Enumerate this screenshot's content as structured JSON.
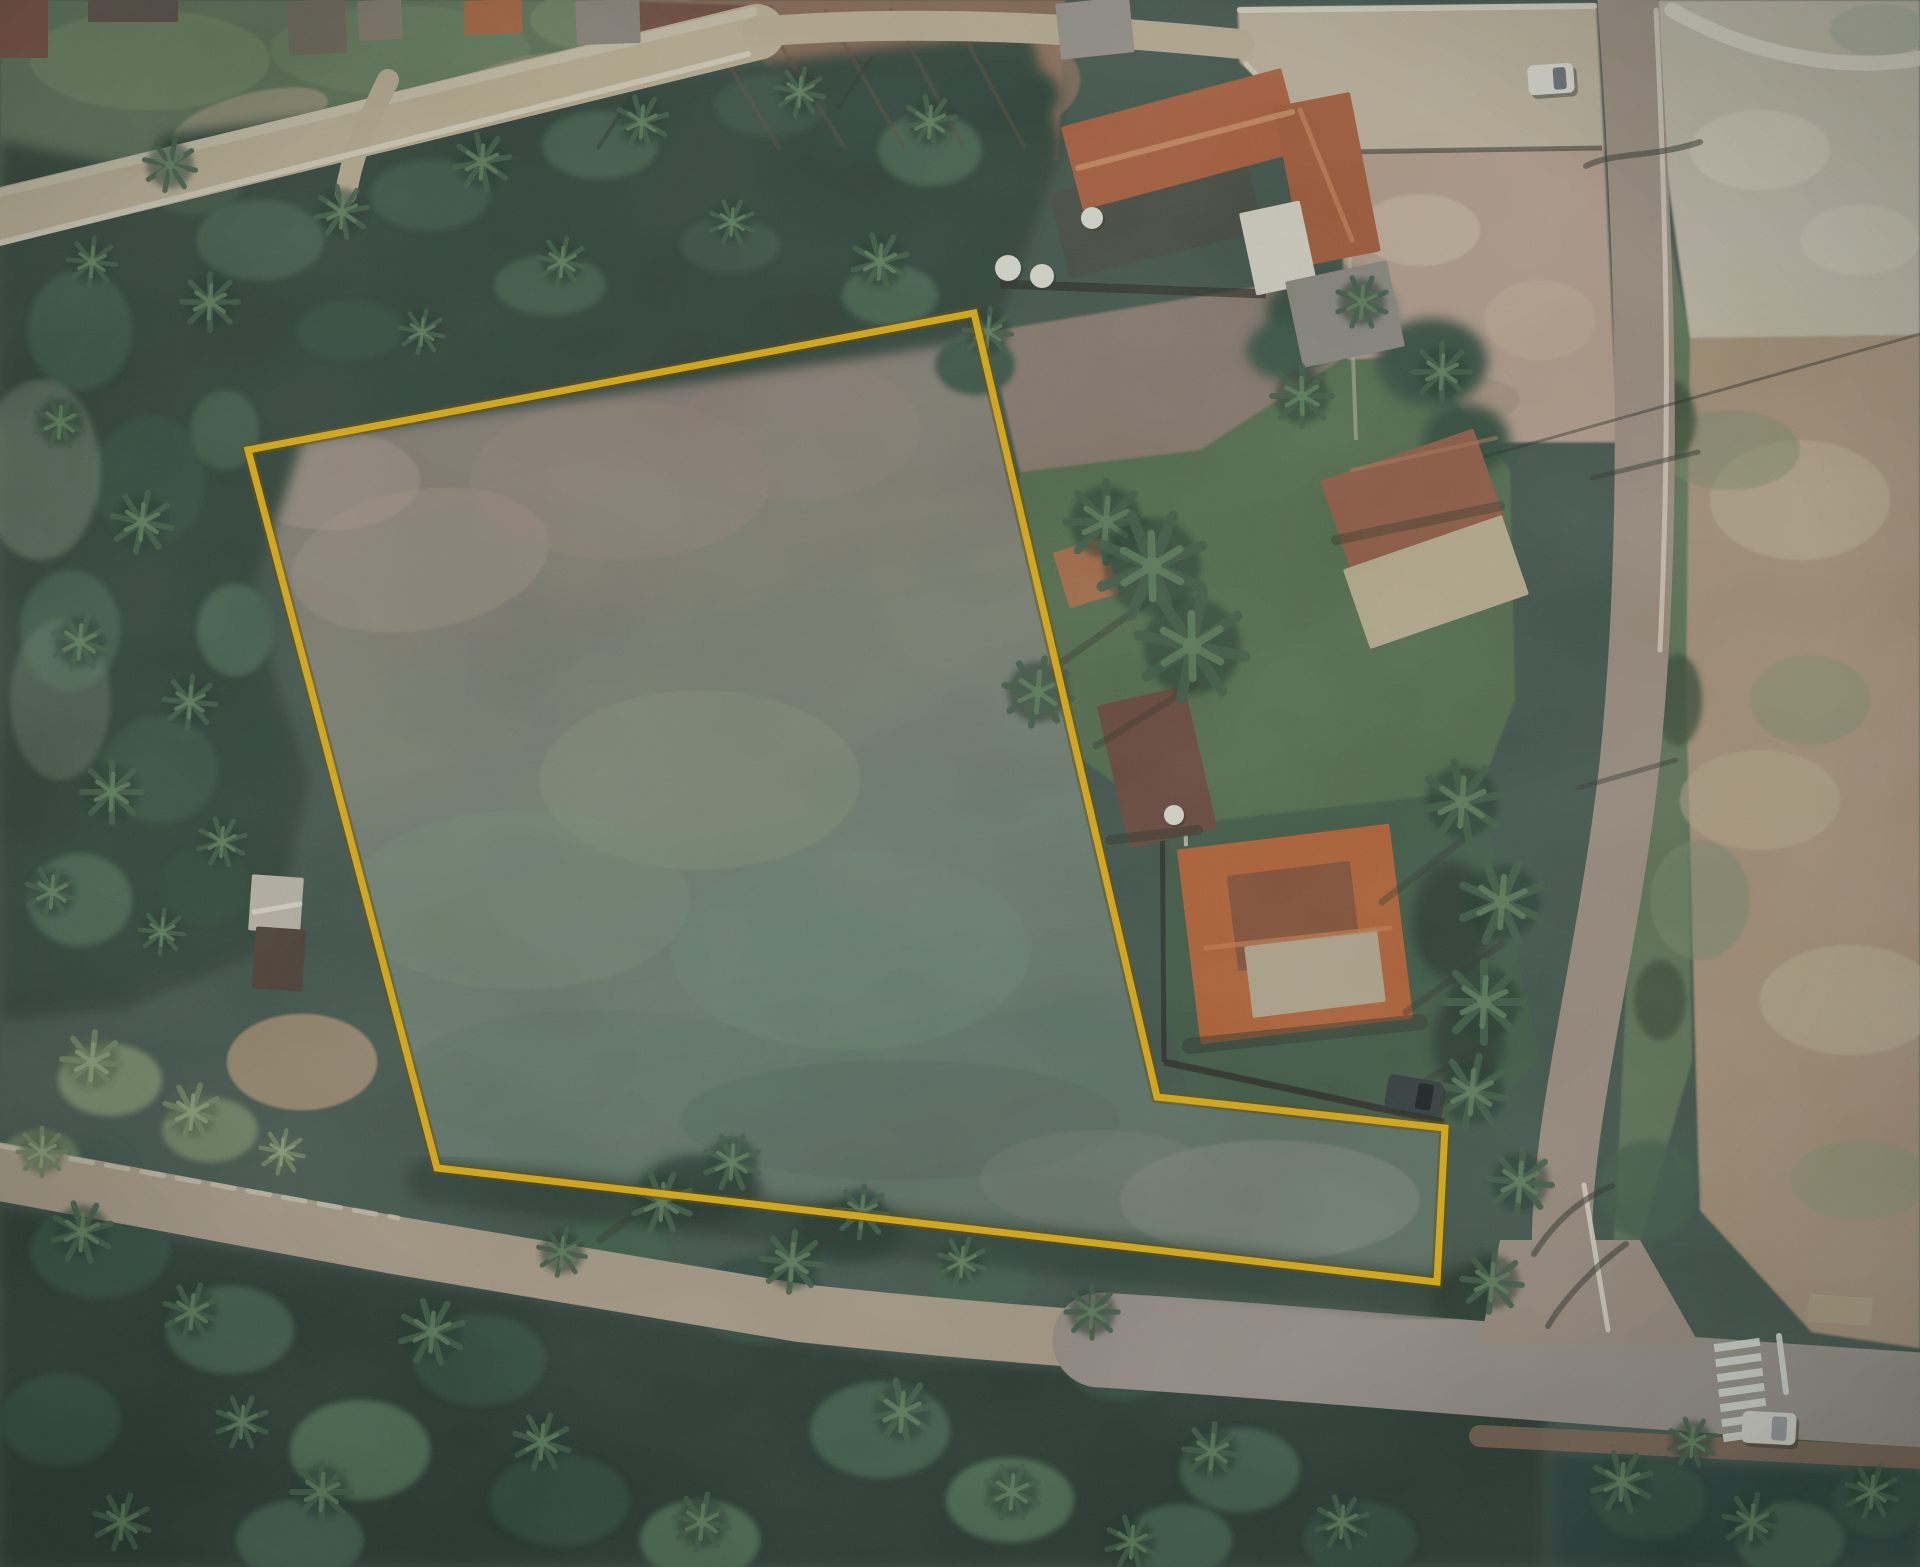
{
  "meta": {
    "description": "Satellite aerial photograph of a rural land parcel outlined with a yellow property boundary overlay",
    "canvas": {
      "w": 1920,
      "h": 1567
    }
  },
  "overlay": {
    "property_boundary": {
      "color": "#F6B80C",
      "outline_color": "#5F4A00",
      "stroke_width": 7,
      "outline_width": 12,
      "vertices": [
        [
          248,
          450
        ],
        [
          974,
          313
        ],
        [
          1157,
          1097
        ],
        [
          1445,
          1128
        ],
        [
          1437,
          1282
        ],
        [
          437,
          1168
        ]
      ]
    }
  },
  "palette": {
    "boundary_yellow": "#F6B80C",
    "parcel_dirt": "#8E7F75",
    "parcel_grass": "#6E8070",
    "forest_dark": "#20312A",
    "road_tan": "#C7B798",
    "road_gray": "#9D938B",
    "roof_orange": "#C25F2F",
    "roof_rust": "#9A5A40",
    "concrete_white": "#ECE5D0",
    "sand_field": "#C9C0AC",
    "dirt_field": "#AE957A"
  },
  "scene": {
    "roads": [
      {
        "name": "street-top-left",
        "d": "M 0,217 L 757,32",
        "color": "#c7b798",
        "width": 56
      },
      {
        "name": "street-top-left-shoulder",
        "d": "M 0,192 L 752,12",
        "color": "#dcd2b8",
        "width": 10,
        "opacity": 0.7
      },
      {
        "name": "lane-top",
        "d": "M 757,32 C 900,20 1060,26 1240,44",
        "color": "#c4b496",
        "width": 30
      },
      {
        "name": "driveway-spur",
        "d": "M 388,80 C 368,122 352,152 346,194",
        "color": "#c4b496",
        "width": 22
      },
      {
        "name": "road-east",
        "d": "M 1626,-20 C 1646,250 1654,520 1630,760 C 1608,960 1560,1120 1562,1250 L 1606,1345",
        "color": "#a39181",
        "width": 60
      },
      {
        "name": "road-south-west",
        "d": "M -20,1168 L 400,1246 L 800,1313 C 960,1330 1060,1337 1160,1344",
        "color": "#b2a189",
        "width": 58
      },
      {
        "name": "road-south-east",
        "d": "M 1100,1340 C 1300,1352 1490,1372 1920,1400",
        "color": "#9d938b",
        "width": 95
      },
      {
        "name": "junction-patch",
        "d": "M 1500,1240 L 1640,1240 L 1700,1345 L 1480,1345 Z",
        "color": "#a39181",
        "fill": true
      },
      {
        "name": "shoulder-south-east",
        "d": "M 1480,1436 L 1920,1458",
        "color": "#8a6750",
        "width": 22,
        "opacity": 0.8
      }
    ],
    "markings": [
      {
        "name": "curb-top-road",
        "d": "M 0,243 L 748,54",
        "color": "#eae2cb",
        "width": 6,
        "opacity": 0.85
      },
      {
        "name": "curb-road-east-upper",
        "d": "M 1656,10 C 1668,250 1670,440 1660,650",
        "color": "#e6dfca",
        "width": 5,
        "opacity": 0.8
      },
      {
        "name": "curb-road-east-lower",
        "d": "M 1584,1185 L 1608,1330",
        "color": "#eee8d6",
        "width": 5,
        "opacity": 0.85
      },
      {
        "name": "curb-road-south",
        "d": "M 0,1146 L 398,1218",
        "color": "#e6ddc6",
        "width": 5,
        "opacity": 0.6,
        "dash": "22 14"
      },
      {
        "name": "stop-line",
        "d": "M 1779,1336 L 1786,1392",
        "color": "#eef0e8",
        "width": 6,
        "opacity": 0.9
      },
      {
        "name": "yard-edge-white",
        "d": "M 1240,10 L 1594,6",
        "color": "#ece5d0",
        "width": 6,
        "opacity": 0.9
      },
      {
        "name": "yard-edge-curve",
        "d": "M 1246,64 C 1300,122 1322,140 1342,152",
        "color": "#e8e0ca",
        "width": 5,
        "opacity": 0.8
      },
      {
        "name": "path-ne-corner",
        "d": "M 1672,10 C 1756,58 1850,72 1920,58",
        "color": "#e9e2cf",
        "width": 15,
        "opacity": 0.85
      }
    ],
    "crosswalk": {
      "x": 1714,
      "y": 1341,
      "bar_w": 46,
      "bar_h": 8,
      "count": 7,
      "step": 15,
      "skew_x": 1.5,
      "rot": -8,
      "color": "#eef0e8",
      "opacity": 0.92
    },
    "walls": [
      {
        "d": "M 1162,782 L 1164,1062",
        "w": 5,
        "o": 0.75
      },
      {
        "d": "M 1164,1062 L 1444,1122",
        "w": 7,
        "o": 0.8
      },
      {
        "d": "M 1000,284 L 1266,294",
        "w": 9,
        "o": 0.65
      },
      {
        "d": "M 1338,152 L 1602,148",
        "w": 5,
        "o": 0.55
      },
      {
        "d": "M 1346,154 L 1356,440",
        "w": 4,
        "o": 0.5,
        "color": "#d8cdb4"
      },
      {
        "d": "M 1184,782 L 1186,846",
        "w": 4,
        "o": 0.8,
        "color": "#ded8c6"
      },
      {
        "d": "M 1430,472 L 1920,334",
        "w": 3,
        "o": 0.45
      }
    ],
    "tree_shadow_band": {
      "d": "M 430,1180 L 1440,1296",
      "color": "#1f2d24",
      "w": 46,
      "o": 0.55
    },
    "buildings": [
      {
        "name": "house-roof-dark-red",
        "x": 0,
        "y": 0,
        "w": 48,
        "h": 58,
        "rot": 0,
        "color": "#7a4538"
      },
      {
        "name": "house-roof",
        "x": 88,
        "y": 0,
        "w": 90,
        "h": 22,
        "rot": 0,
        "color": "#564a40"
      },
      {
        "name": "house-roof",
        "x": 288,
        "y": 0,
        "w": 58,
        "h": 54,
        "rot": -3,
        "color": "#6f6557"
      },
      {
        "name": "house-roof",
        "x": 358,
        "y": 0,
        "w": 44,
        "h": 40,
        "rot": -3,
        "color": "#837a69"
      },
      {
        "name": "house-roof-orange",
        "x": 464,
        "y": 0,
        "w": 58,
        "h": 34,
        "rot": -2,
        "color": "#b05f36"
      },
      {
        "name": "house-roof",
        "x": 576,
        "y": 0,
        "w": 64,
        "h": 44,
        "rot": -2,
        "color": "#8d857a"
      },
      {
        "name": "house-roof",
        "x": 1058,
        "y": 0,
        "w": 74,
        "h": 56,
        "rot": -6,
        "color": "#9a958c"
      },
      {
        "name": "farm-court-dark",
        "x": 1056,
        "y": 168,
        "w": 200,
        "h": 88,
        "rot": -14,
        "color": "#43473d"
      },
      {
        "name": "farmhouse-main-wing",
        "x": 1068,
        "y": 96,
        "w": 228,
        "h": 86,
        "rot": -15,
        "color": "#b55c35"
      },
      {
        "name": "farmhouse-south-wing",
        "x": 1288,
        "y": 98,
        "w": 78,
        "h": 162,
        "rot": -11,
        "color": "#ad5833"
      },
      {
        "name": "white-annex",
        "x": 1247,
        "y": 206,
        "w": 62,
        "h": 84,
        "rot": -12,
        "color": "#e7e2d2"
      },
      {
        "name": "gray-building",
        "x": 1293,
        "y": 270,
        "w": 104,
        "h": 88,
        "rot": -12,
        "color": "#8f8c81"
      },
      {
        "name": "house-rust-roof",
        "x": 1332,
        "y": 452,
        "w": 162,
        "h": 100,
        "rot": -19,
        "color": "#9a5a40"
      },
      {
        "name": "house-khaki-roof",
        "x": 1352,
        "y": 540,
        "w": 168,
        "h": 84,
        "rot": -19,
        "color": "#c6b795"
      },
      {
        "name": "shed-orange",
        "x": 1060,
        "y": 544,
        "w": 52,
        "h": 58,
        "rot": -17,
        "color": "#b06a42"
      },
      {
        "name": "house-brown",
        "x": 1112,
        "y": 694,
        "w": 90,
        "h": 146,
        "rot": -13,
        "color": "#6b4336"
      },
      {
        "name": "big-house-orange",
        "x": 1188,
        "y": 836,
        "w": 214,
        "h": 196,
        "rot": -7,
        "color": "#c25f2f"
      },
      {
        "name": "big-house-rust-patch",
        "x": 1232,
        "y": 868,
        "w": 124,
        "h": 96,
        "rot": -7,
        "color": "#8c4c31"
      },
      {
        "name": "big-house-terrace",
        "x": 1248,
        "y": 938,
        "w": 134,
        "h": 72,
        "rot": -7,
        "color": "#c0b093"
      },
      {
        "name": "shed-left-roof",
        "x": 250,
        "y": 876,
        "w": 52,
        "h": 56,
        "rot": 4,
        "color": "#c9c3b2"
      },
      {
        "name": "shed-left-base",
        "x": 254,
        "y": 928,
        "w": 50,
        "h": 62,
        "rot": 4,
        "color": "#4a3a30"
      },
      {
        "name": "east-low-structure",
        "x": 1808,
        "y": 1296,
        "w": 64,
        "h": 28,
        "rot": 4,
        "color": "#b5a383"
      }
    ],
    "ridges": [
      {
        "d": "M 1078,168 L 1292,112",
        "color": "#d98f5e",
        "w": 6,
        "o": 0.9
      },
      {
        "d": "M 1300,110 L 1352,240",
        "color": "#d08453",
        "w": 5,
        "o": 0.8
      },
      {
        "d": "M 1206,948 L 1390,928",
        "color": "#d8804b",
        "w": 5,
        "o": 0.7
      },
      {
        "d": "M 1352,470 L 1496,438",
        "color": "#b87a58",
        "w": 4,
        "o": 0.6
      },
      {
        "d": "M 300,904 L 254,912",
        "color": "#efe9d9",
        "w": 5,
        "o": 0.9
      }
    ],
    "tanks": [
      [
        1092,
        218,
        11
      ],
      [
        1174,
        815,
        10
      ],
      [
        1008,
        268,
        13
      ],
      [
        1042,
        276,
        12
      ]
    ],
    "shadow_lines": [
      {
        "d": "M 632,96 L 598,148",
        "w": 4,
        "o": 0.5
      },
      {
        "d": "M 872,58 L 838,108",
        "w": 4,
        "o": 0.5
      },
      {
        "d": "M 1700,142 C 1652,158 1612,152 1586,166",
        "w": 6,
        "o": 0.55
      },
      {
        "d": "M 1698,452 L 1592,478",
        "w": 5,
        "o": 0.5
      },
      {
        "d": "M 1676,760 L 1578,788",
        "w": 5,
        "o": 0.45
      },
      {
        "d": "M 1612,1186 C 1572,1202 1548,1232 1534,1254",
        "w": 6,
        "o": 0.55
      },
      {
        "d": "M 1626,1244 C 1592,1268 1562,1302 1548,1326",
        "w": 6,
        "o": 0.55
      },
      {
        "d": "M 1150,600 L 1062,662",
        "w": 7,
        "o": 0.4
      },
      {
        "d": "M 1196,684 L 1096,746",
        "w": 7,
        "o": 0.4
      },
      {
        "d": "M 1470,834 L 1382,902",
        "w": 7,
        "o": 0.4
      },
      {
        "d": "M 1502,944 L 1406,1012",
        "w": 7,
        "o": 0.4
      },
      {
        "d": "M 1484,1044 L 1398,1098",
        "w": 6,
        "o": 0.4
      },
      {
        "d": "M 1190,1046 L 1420,1022",
        "w": 16,
        "o": 0.5
      },
      {
        "d": "M 1336,540 L 1500,506",
        "w": 10,
        "o": 0.4
      },
      {
        "d": "M 1110,840 L 1198,830",
        "w": 10,
        "o": 0.5
      },
      {
        "d": "M 660,1196 L 600,1240",
        "w": 8,
        "o": 0.4
      },
      {
        "d": "M 840,1232 L 780,1276",
        "w": 8,
        "o": 0.4
      }
    ],
    "furrows": [
      {
        "d": "M 700,15 L 780,150"
      },
      {
        "d": "M 760,12 L 845,148"
      },
      {
        "d": "M 825,10 L 905,150"
      },
      {
        "d": "M 890,8 L 965,150"
      },
      {
        "d": "M 950,10 L 1025,148"
      }
    ],
    "palms_dark": [
      [
        170,
        165,
        26
      ],
      [
        92,
        262,
        24
      ],
      [
        210,
        302,
        28
      ],
      [
        60,
        422,
        26
      ],
      [
        142,
        522,
        30
      ],
      [
        80,
        642,
        28
      ],
      [
        190,
        702,
        26
      ],
      [
        112,
        792,
        30
      ],
      [
        222,
        842,
        24
      ],
      [
        52,
        892,
        26
      ],
      [
        162,
        932,
        22
      ],
      [
        342,
        212,
        26
      ],
      [
        482,
        162,
        28
      ],
      [
        642,
        122,
        26
      ],
      [
        800,
        92,
        24
      ],
      [
        930,
        122,
        26
      ],
      [
        562,
        262,
        24
      ],
      [
        732,
        222,
        22
      ],
      [
        880,
        262,
        28
      ],
      [
        988,
        332,
        24
      ],
      [
        422,
        332,
        22
      ],
      [
        1106,
        522,
        40
      ],
      [
        1152,
        566,
        54
      ],
      [
        1192,
        646,
        54
      ],
      [
        1038,
        692,
        34
      ],
      [
        1302,
        396,
        30
      ],
      [
        1442,
        372,
        28
      ],
      [
        1362,
        302,
        26
      ],
      [
        1462,
        802,
        40
      ],
      [
        1502,
        902,
        42
      ],
      [
        1484,
        1002,
        40
      ],
      [
        1472,
        1092,
        36
      ],
      [
        1520,
        1182,
        32
      ],
      [
        82,
        1232,
        30
      ],
      [
        192,
        1312,
        28
      ],
      [
        322,
        1492,
        30
      ],
      [
        432,
        1332,
        32
      ],
      [
        542,
        1442,
        28
      ],
      [
        662,
        1202,
        30
      ],
      [
        702,
        1522,
        28
      ],
      [
        792,
        1262,
        30
      ],
      [
        902,
        1412,
        32
      ],
      [
        1012,
        1492,
        28
      ],
      [
        1092,
        1312,
        26
      ],
      [
        1212,
        1452,
        28
      ],
      [
        1342,
        1522,
        26
      ],
      [
        562,
        1252,
        24
      ],
      [
        242,
        1422,
        26
      ],
      [
        122,
        1522,
        28
      ],
      [
        962,
        1262,
        24
      ],
      [
        1132,
        1542,
        26
      ],
      [
        1622,
        1482,
        30
      ],
      [
        1752,
        1522,
        28
      ],
      [
        1872,
        1492,
        26
      ],
      [
        1692,
        1442,
        24
      ],
      [
        732,
        1162,
        28
      ],
      [
        862,
        1212,
        26
      ],
      [
        1492,
        1282,
        30
      ]
    ],
    "palms_olive": [
      [
        92,
        1062,
        30
      ],
      [
        192,
        1112,
        28
      ],
      [
        42,
        1152,
        24
      ],
      [
        282,
        1152,
        22
      ]
    ],
    "vehicles": [
      {
        "name": "white-car",
        "x": 1528,
        "y": 64,
        "w": 46,
        "h": 30,
        "rot": -4,
        "color": "#eceadf",
        "window": "#6b7077"
      },
      {
        "name": "dark-car",
        "x": 1386,
        "y": 1078,
        "w": 56,
        "h": 34,
        "rot": 10,
        "color": "#2e3437",
        "window": "#15181a"
      },
      {
        "name": "white-truck",
        "x": 1742,
        "y": 1412,
        "w": 54,
        "h": 32,
        "rot": 3,
        "color": "#e8e6da",
        "window": "#9aa0a3"
      }
    ]
  }
}
